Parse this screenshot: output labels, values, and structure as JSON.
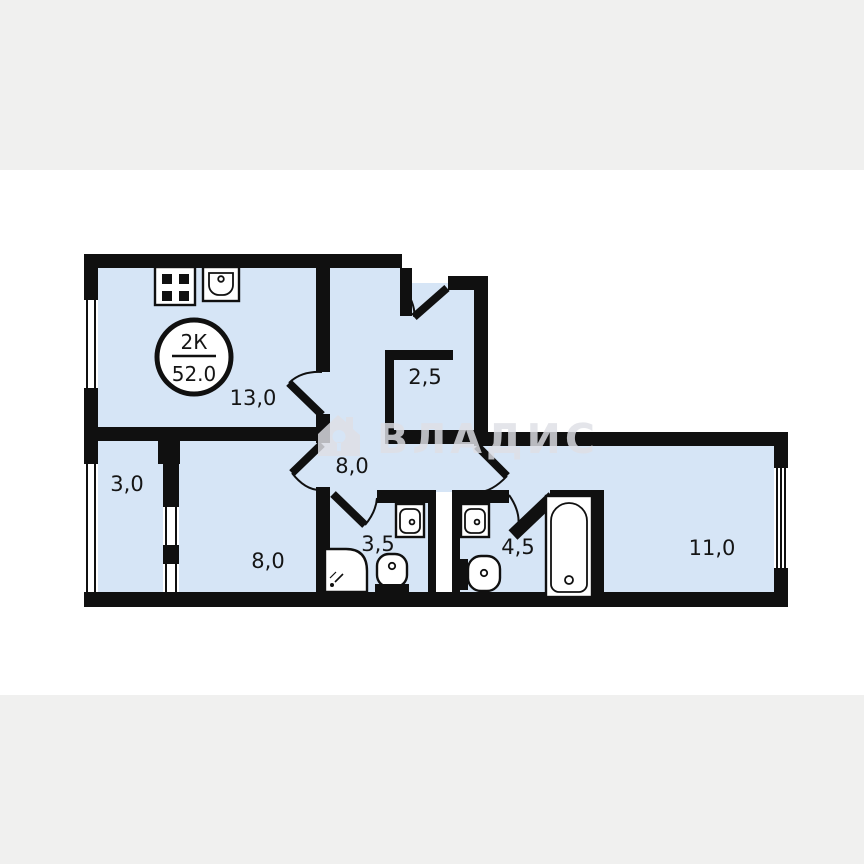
{
  "plan": {
    "badge": {
      "type": "2К",
      "area": "52.0"
    },
    "rooms": {
      "kitchen": {
        "area": "13,0"
      },
      "closet": {
        "area": "2,5"
      },
      "hall": {
        "area": "8,0"
      },
      "balcony": {
        "area": "3,0"
      },
      "bedroom": {
        "area": "8,0"
      },
      "bathroom_small": {
        "area": "3,5"
      },
      "bathroom_large": {
        "area": "4,5"
      },
      "living": {
        "area": "11,0"
      }
    },
    "fixtures": [
      "stove",
      "kitchen-sink",
      "bathroom-sink",
      "bathroom-sink",
      "toilet",
      "toilet",
      "shower",
      "bathtub"
    ],
    "colors": {
      "floor": "#d6e5f6",
      "wall": "#101010",
      "background_band": "#f0f0ef",
      "watermark": "#dfe0e6"
    }
  },
  "watermark": {
    "text": "ВЛАДИС",
    "icon": "house-key-icon"
  }
}
